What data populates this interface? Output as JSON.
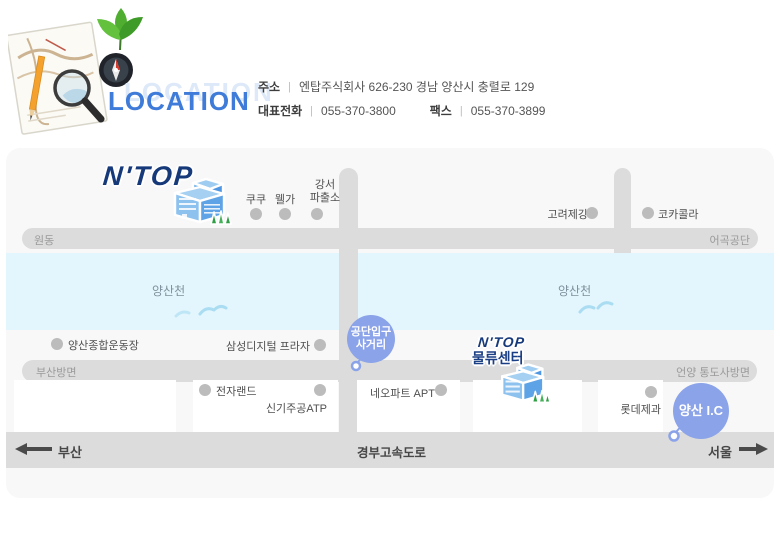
{
  "header": {
    "title": "LOCATION",
    "separator": "|",
    "address_label": "주소",
    "address_value": "엔탑주식회사 626-230 경남 양산시 충렬로 129",
    "phone_label": "대표전화",
    "phone_value": "055-370-3800",
    "fax_label": "팩스",
    "fax_value": "055-370-3899"
  },
  "map": {
    "company_logo": "N'TOP",
    "logistics_center": {
      "logo": "N'TOP",
      "label": "물류센터"
    },
    "roads": {
      "wondong": "원동",
      "eogok_industrial": "어곡공단",
      "busan_direction": "부산방면",
      "eonyang_tongdosa": "언양 통도사방면",
      "gyeongbu_expressway": "경부고속도로",
      "busan": "부산",
      "seoul": "서울"
    },
    "river": {
      "name": "양산천"
    },
    "junctions": {
      "industrial_entrance_line1": "공단입구",
      "industrial_entrance_line2": "사거리",
      "yangsan_ic": "양산 I.C"
    },
    "pois": {
      "kuku": "쿠쿠",
      "welga": "웰가",
      "gangseo_line1": "강서",
      "gangseo_line2": "파출소",
      "korea_steel": "고려제강",
      "coca_cola": "코카콜라",
      "yangsan_stadium": "양산종합운동장",
      "samsung_digital_plaza": "삼성디지털 프라자",
      "electro_land": "전자랜드",
      "singi_jugong_atp": "신기주공ATP",
      "neo_apt": "네오파트 APT",
      "lotte_confectionery": "롯데제과"
    }
  },
  "colors": {
    "title_blue": "#3f7bd8",
    "logo_navy": "#16397a",
    "junction_blue": "#8ba3e8",
    "road_gray": "#dcdcdc",
    "river_blue": "#e4f6fd",
    "map_bg": "#f8f8f8"
  }
}
